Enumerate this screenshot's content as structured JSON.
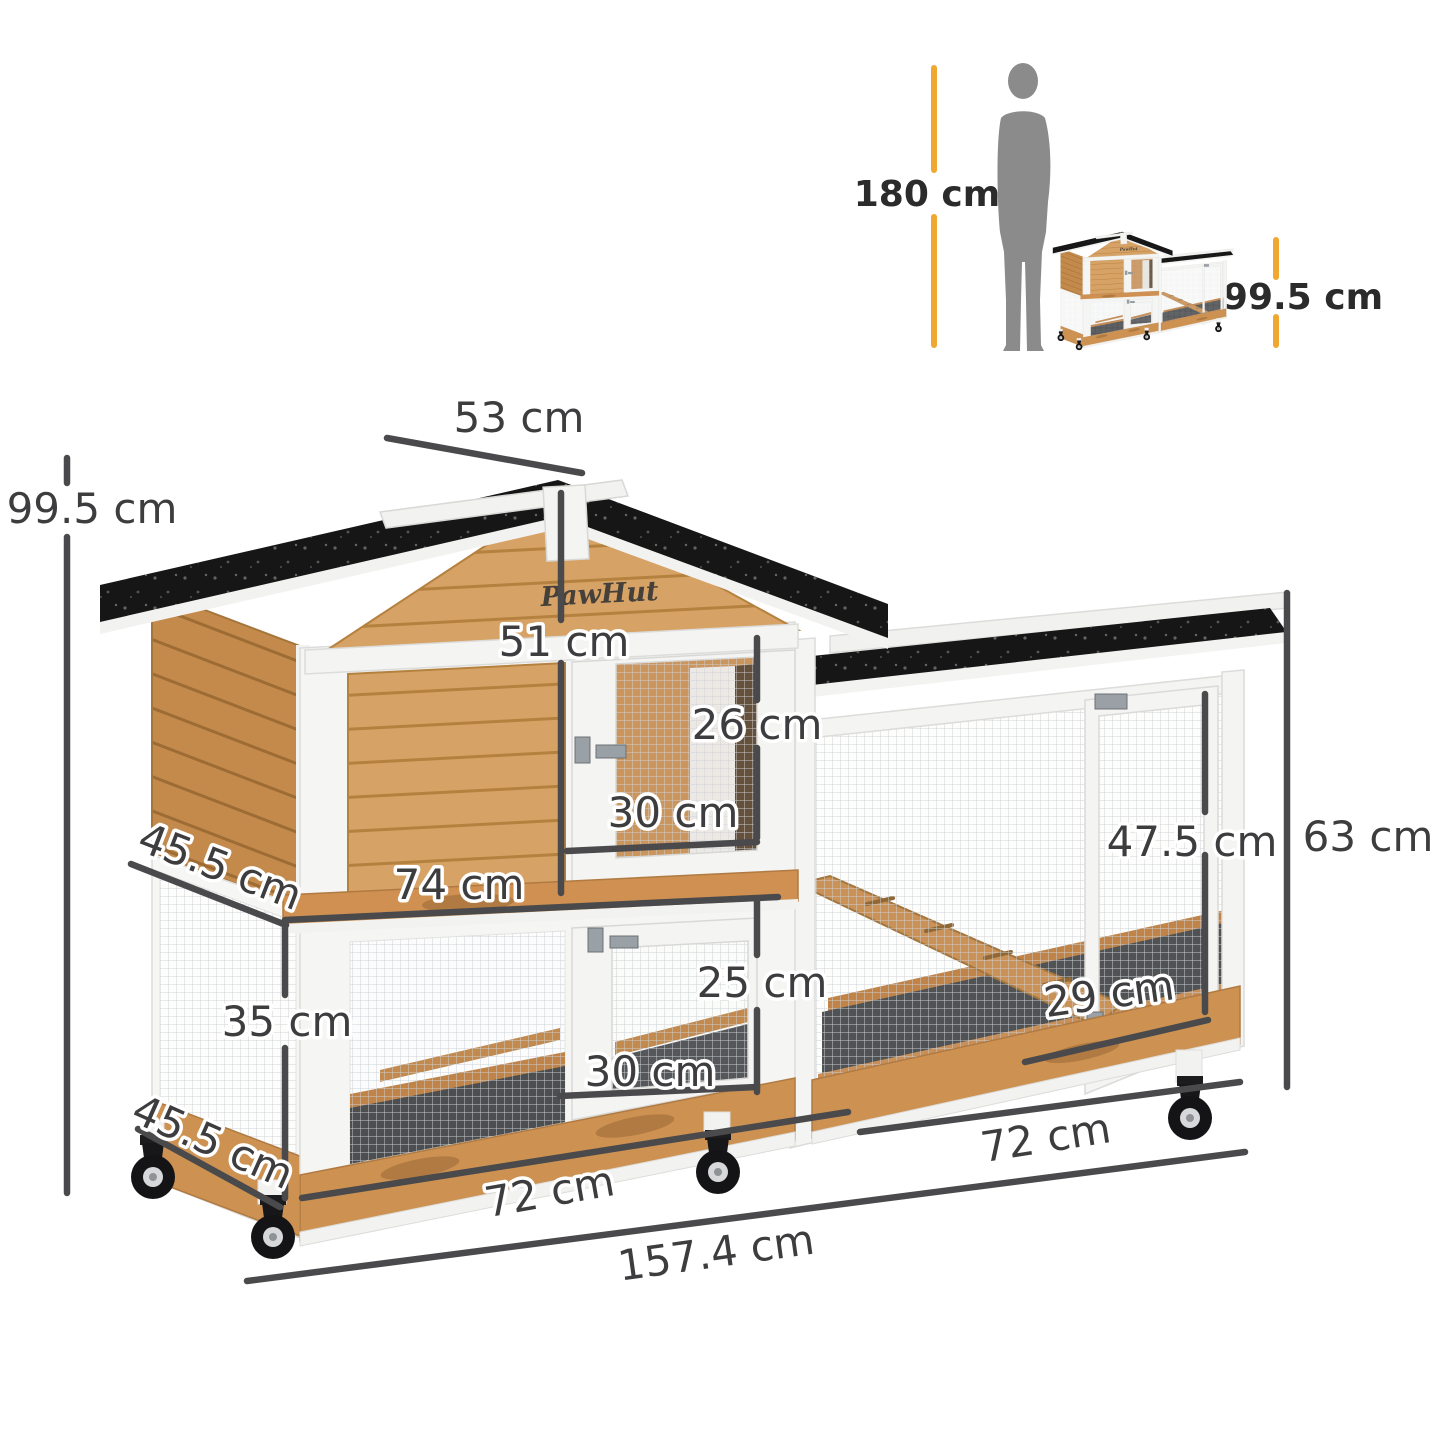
{
  "brand_logo": "PawHut",
  "reference_scale": {
    "person_height_label": "180 cm",
    "product_height_label": "99.5 cm"
  },
  "dimension_labels": {
    "overall_height": "99.5 cm",
    "roof_width": "53 cm",
    "upper_hutch_height": "51 cm",
    "upper_door_height": "26 cm",
    "upper_door_width": "30 cm",
    "upper_level_width": "74 cm",
    "upper_level_depth": "45.5 cm",
    "lower_level_height": "35 cm",
    "lower_level_depth": "45.5 cm",
    "lower_door_height": "25 cm",
    "lower_door_width": "30 cm",
    "run_floor_depth": "29 cm",
    "run_door_height": "47.5 cm",
    "run_height": "63 cm",
    "hutch_base_width": "72 cm",
    "run_base_width": "72 cm",
    "total_width": "157.4 cm"
  },
  "colors": {
    "accent_yellow": "#F0A830",
    "dimension_line": "#4A4A4C",
    "roof_black": "#161616",
    "wood_light": "#D9A469",
    "wood_mid": "#CE9457",
    "wood_dark": "#C08449",
    "silhouette_gray": "#8B8B8B",
    "frame_white": "#F4F4F2"
  }
}
